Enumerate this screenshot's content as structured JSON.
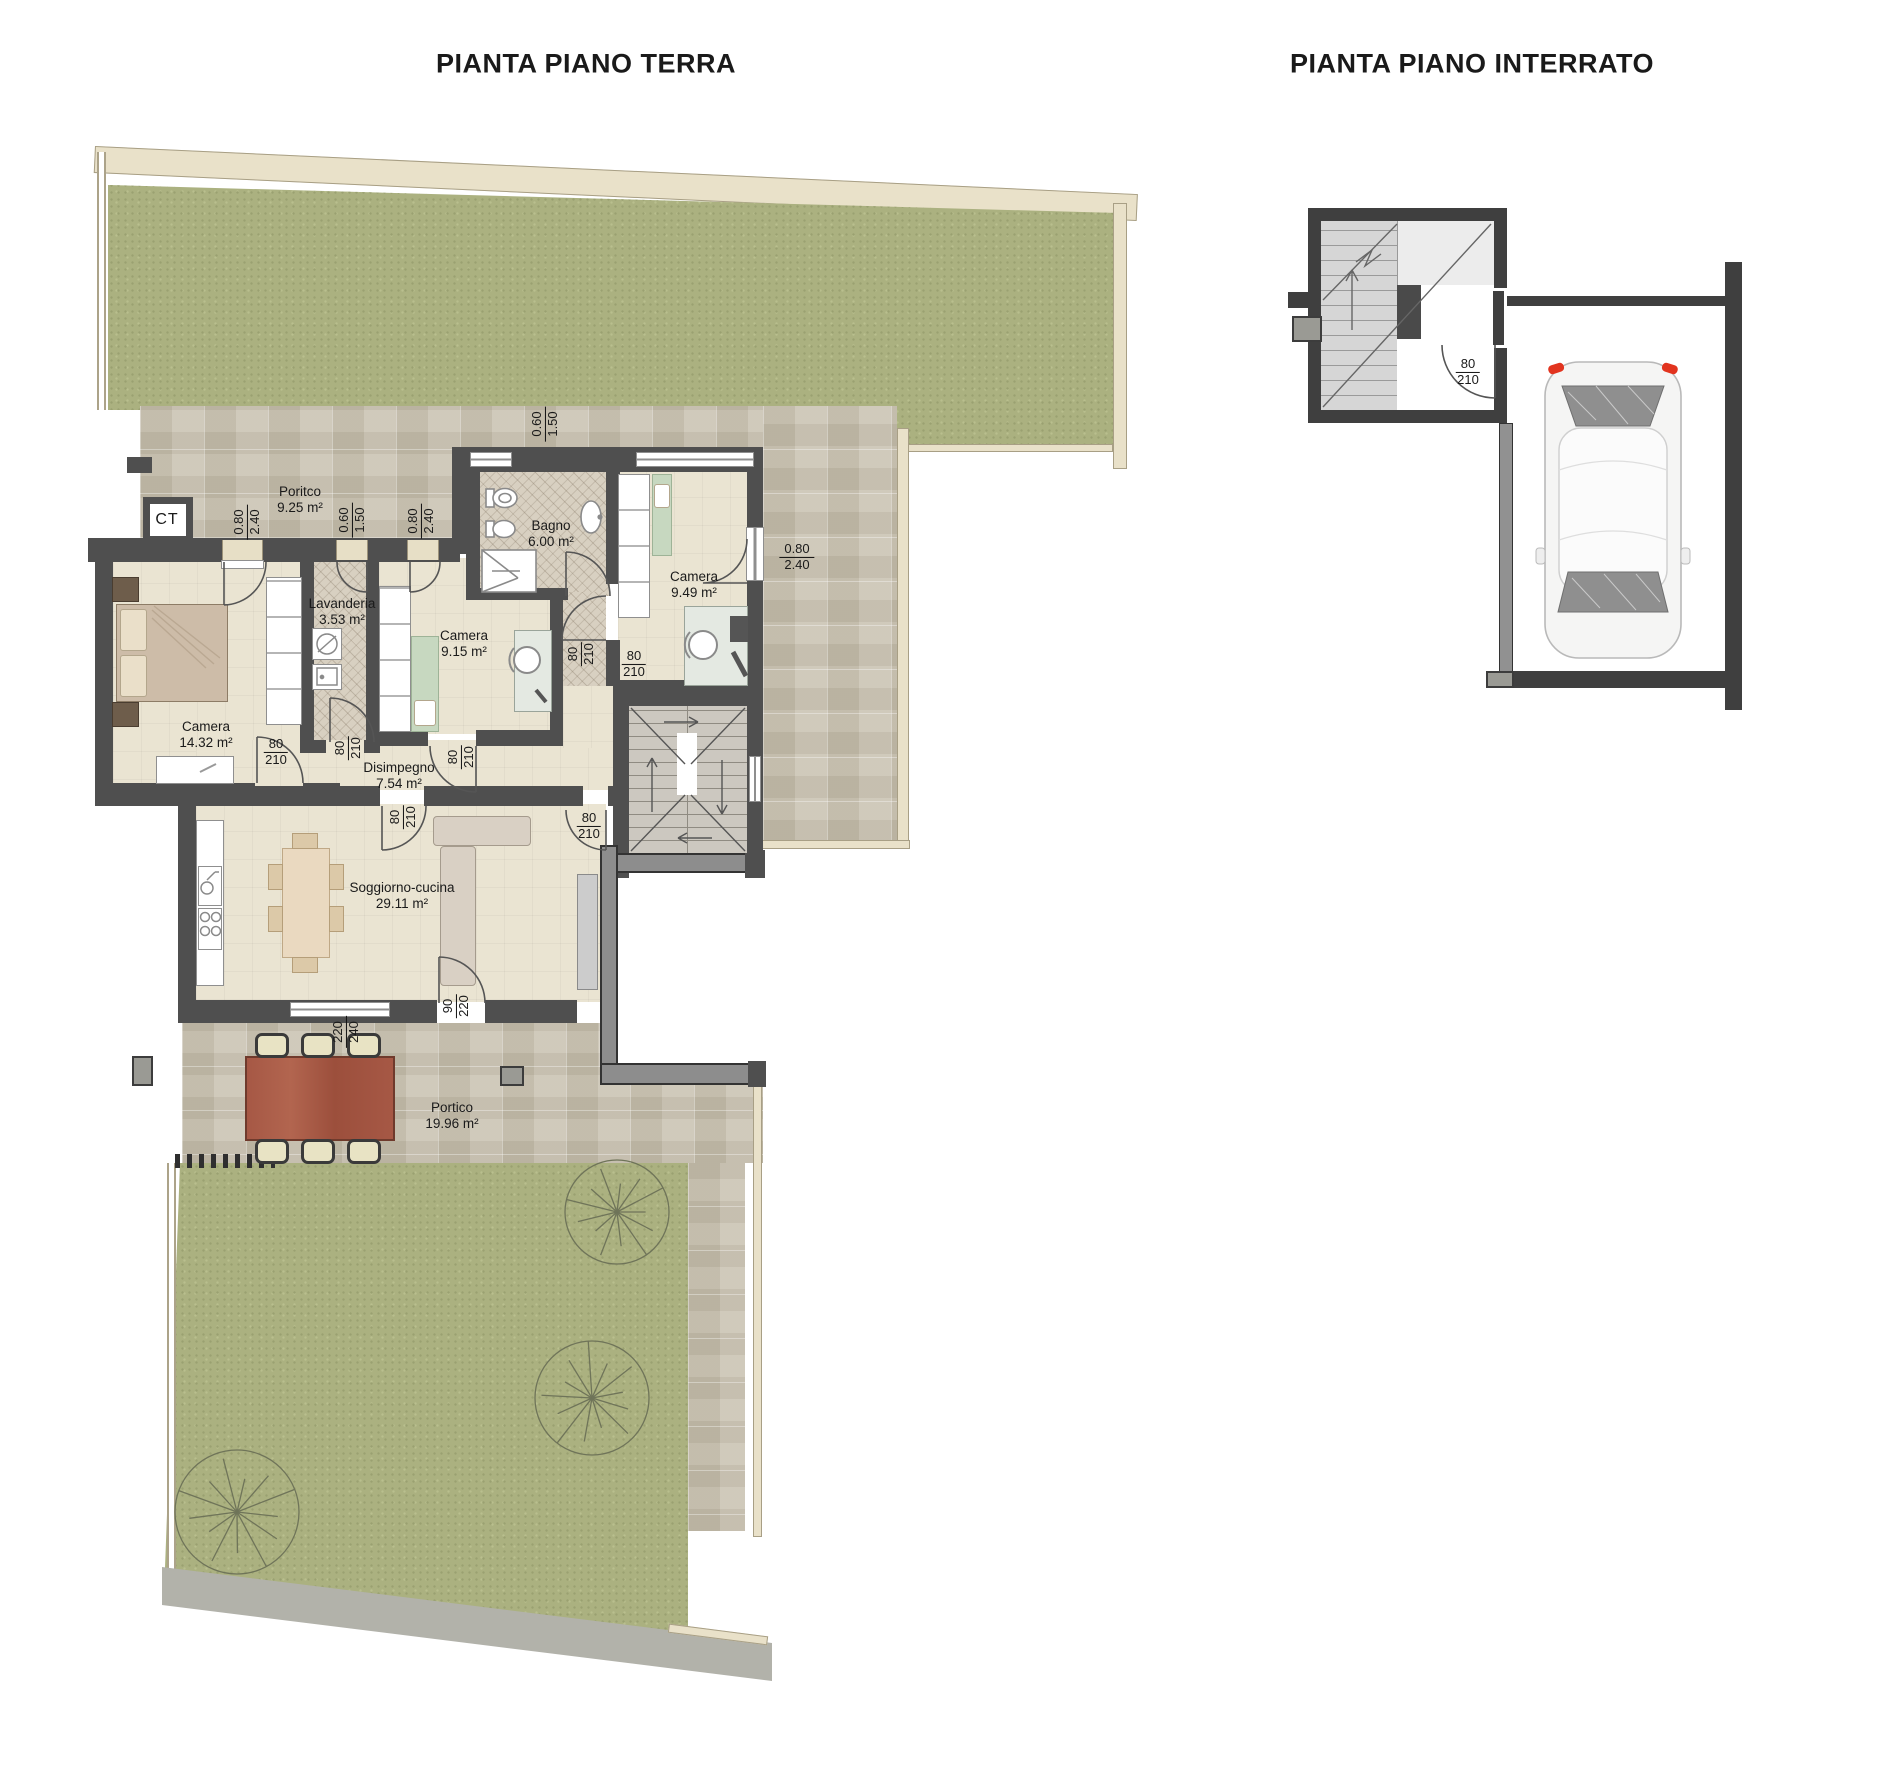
{
  "titles": {
    "ground": "PIANTA PIANO TERRA",
    "basement": "PIANTA PIANO INTERRATO"
  },
  "ground_floor": {
    "ct_label": "CT",
    "rooms": [
      {
        "name": "Poritco",
        "area": "9.25 m²",
        "x": 300,
        "y": 500
      },
      {
        "name": "Bagno",
        "area": "6.00 m²",
        "x": 551,
        "y": 534
      },
      {
        "name": "Camera",
        "area": "9.49 m²",
        "x": 694,
        "y": 585
      },
      {
        "name": "Lavanderia",
        "area": "3.53 m²",
        "x": 342,
        "y": 612
      },
      {
        "name": "Camera",
        "area": "9.15 m²",
        "x": 464,
        "y": 644
      },
      {
        "name": "Camera",
        "area": "14.32 m²",
        "x": 206,
        "y": 735
      },
      {
        "name": "Disimpegno",
        "area": "7.54 m²",
        "x": 399,
        "y": 776
      },
      {
        "name": "Soggiorno-cucina",
        "area": "29.11 m²",
        "x": 402,
        "y": 896
      },
      {
        "name": "Portico",
        "area": "19.96 m²",
        "x": 452,
        "y": 1116
      }
    ],
    "dimensions": [
      {
        "top": "0.80",
        "bottom": "2.40",
        "x": 247,
        "y": 522,
        "rotated": true
      },
      {
        "top": "0.60",
        "bottom": "1.50",
        "x": 352,
        "y": 520,
        "rotated": true
      },
      {
        "top": "0.80",
        "bottom": "2.40",
        "x": 421,
        "y": 521,
        "rotated": true
      },
      {
        "top": "0.60",
        "bottom": "1.50",
        "x": 545,
        "y": 424,
        "rotated": true
      },
      {
        "top": "0.80",
        "bottom": "2.40",
        "x": 797,
        "y": 557,
        "rotated": false
      },
      {
        "top": "80",
        "bottom": "210",
        "x": 581,
        "y": 654,
        "rotated": true
      },
      {
        "top": "80",
        "bottom": "210",
        "x": 634,
        "y": 664,
        "rotated": false
      },
      {
        "top": "80",
        "bottom": "210",
        "x": 276,
        "y": 752,
        "rotated": false
      },
      {
        "top": "80",
        "bottom": "210",
        "x": 348,
        "y": 748,
        "rotated": true
      },
      {
        "top": "80",
        "bottom": "210",
        "x": 461,
        "y": 757,
        "rotated": true
      },
      {
        "top": "80",
        "bottom": "210",
        "x": 403,
        "y": 817,
        "rotated": true
      },
      {
        "top": "80",
        "bottom": "210",
        "x": 589,
        "y": 826,
        "rotated": false
      },
      {
        "top": "90",
        "bottom": "220",
        "x": 456,
        "y": 1006,
        "rotated": true
      },
      {
        "top": "220",
        "bottom": "240",
        "x": 346,
        "y": 1032,
        "rotated": true
      }
    ]
  },
  "basement": {
    "dimensions": [
      {
        "top": "80",
        "bottom": "210",
        "x": 1468,
        "y": 372,
        "rotated": false
      }
    ]
  },
  "colors": {
    "wall": "#4f4f4f",
    "wall_basement": "#3f3f3f",
    "grass": "#abb180",
    "stone_paving": "#c9c2b1",
    "interior_floor": "#eae4d2",
    "marble_floor": "#d8d0c1",
    "border_band": "#e9e1c9",
    "outdoor_table": "#a65845",
    "tail_light": "#e2341f"
  }
}
